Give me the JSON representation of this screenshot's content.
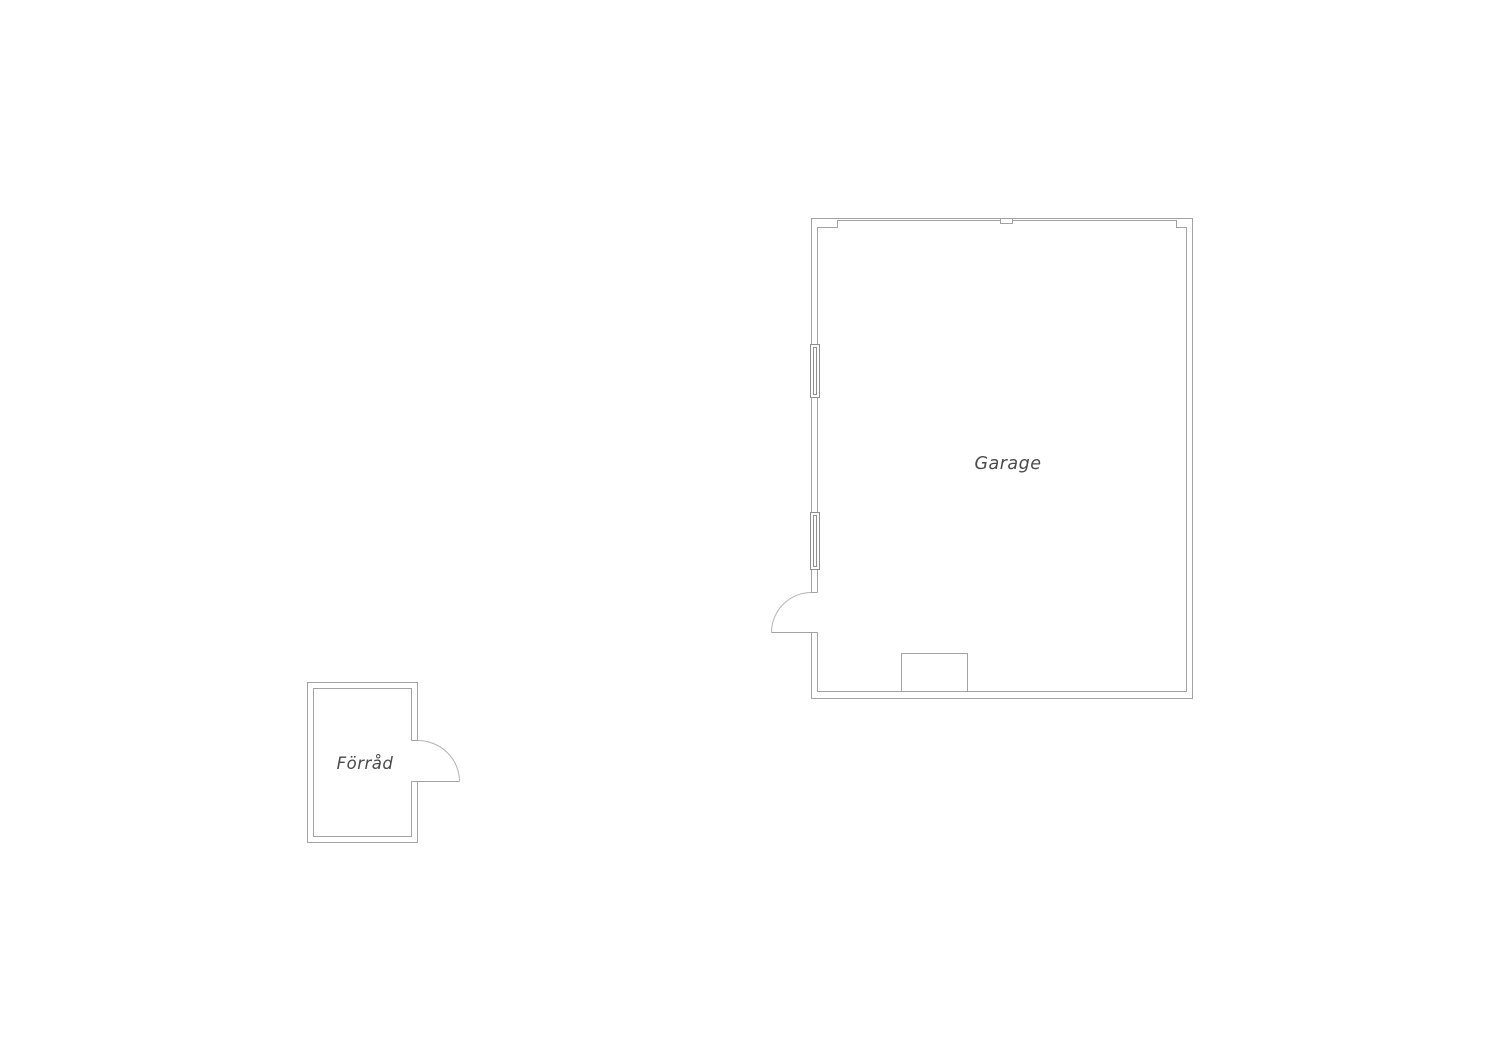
{
  "floorplan": {
    "rooms": [
      {
        "id": "garage",
        "label": "Garage"
      },
      {
        "id": "forrad",
        "label": "Förråd"
      }
    ],
    "features": {
      "garage": [
        "window-upper",
        "window-lower",
        "door-swing-left",
        "top-wall-post",
        "chimney-block"
      ],
      "forrad": [
        "door-swing-right"
      ]
    }
  },
  "colors": {
    "wall": "#a2a2a2",
    "window": "#8f8f8f",
    "arc": "#b4b4b4",
    "label": "#4a4a4a",
    "background": "#ffffff"
  }
}
